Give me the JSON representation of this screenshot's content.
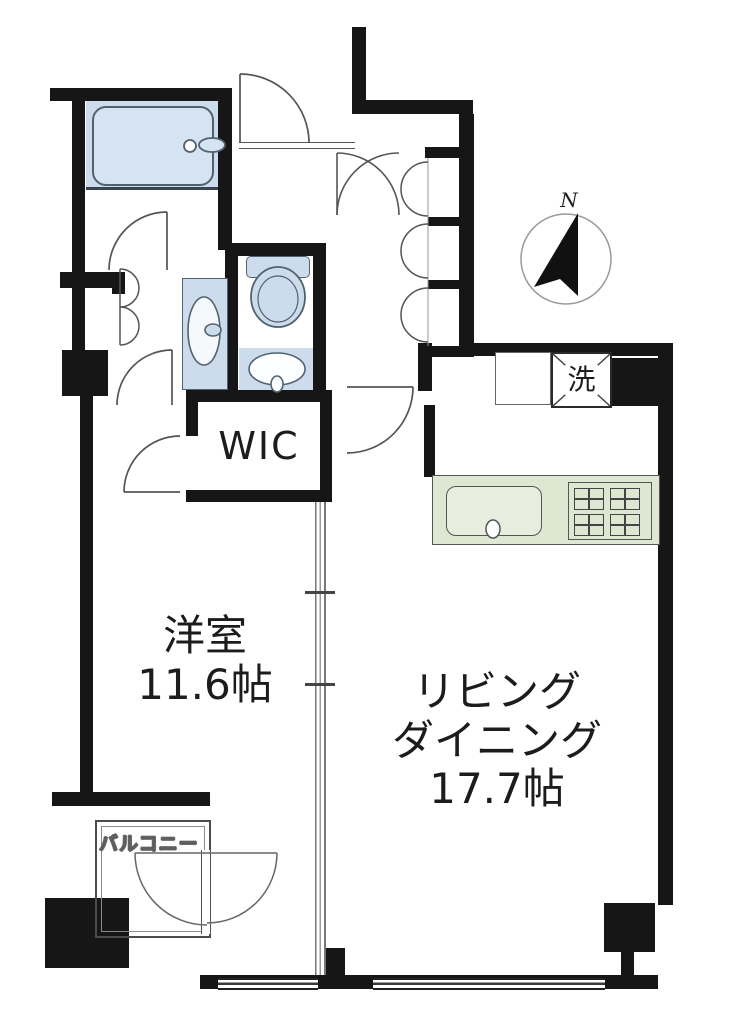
{
  "labels": {
    "bedroom_name": "洋室",
    "bedroom_size": "11.6帖",
    "living_line1": "リビング",
    "living_line2": "ダイニング",
    "living_size": "17.7帖",
    "wic": "WIC",
    "laundry": "洗",
    "balcony": "バルコニー",
    "compass_north": "N"
  },
  "colors": {
    "wall": "#161616",
    "background": "#ffffff",
    "fixture_blue": "#ccdcec",
    "fixture_blue_light": "#d6e3f2",
    "fixture_border": "#51626f",
    "kitchen_green": "#dde7d1",
    "kitchen_green_light": "#e7eedd",
    "line_gray": "#666666"
  }
}
